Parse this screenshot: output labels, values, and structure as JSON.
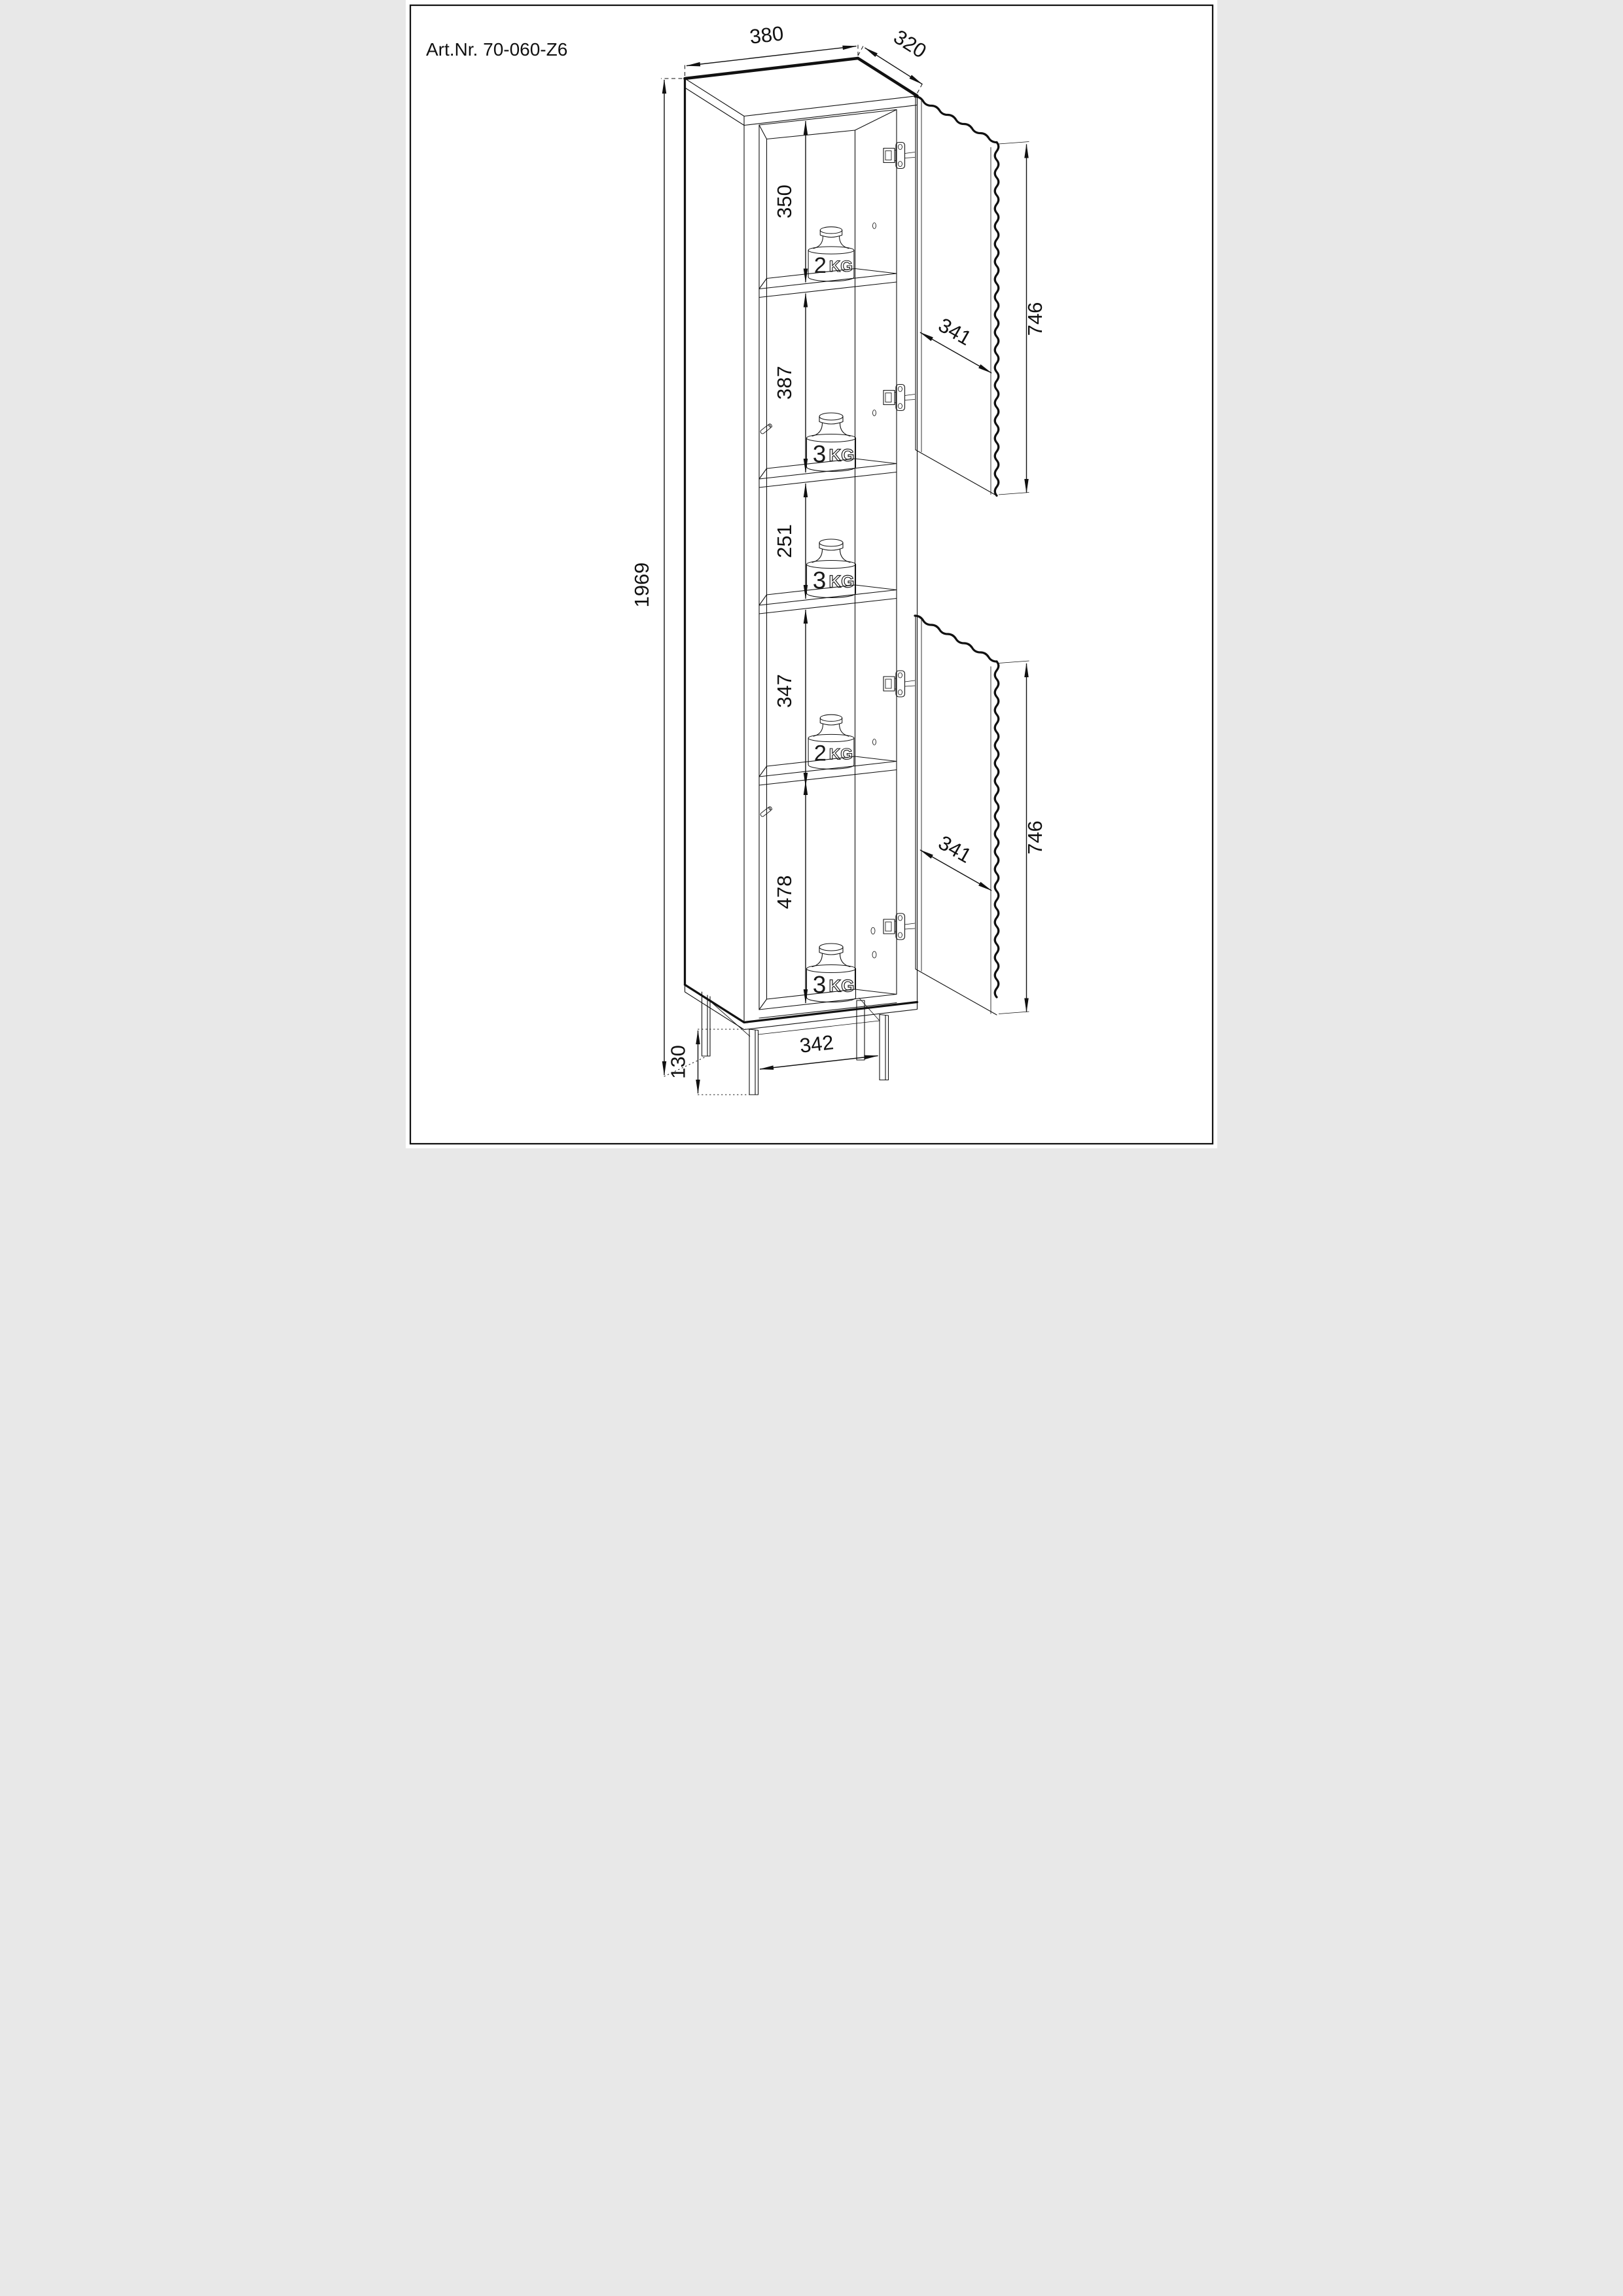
{
  "title": "Art.Nr. 70-060-Z6",
  "dimensions": {
    "width": "380",
    "depth": "320",
    "height": "1969",
    "shelf_gaps": [
      "350",
      "387",
      "251",
      "347",
      "478"
    ],
    "upper_door": {
      "width": "341",
      "height": "746"
    },
    "lower_door": {
      "width": "341",
      "height": "746"
    },
    "base_width": "342",
    "leg_height": "130"
  },
  "weights": [
    {
      "num": "2",
      "unit": "KG"
    },
    {
      "num": "3",
      "unit": "KG"
    },
    {
      "num": "3",
      "unit": "KG"
    },
    {
      "num": "2",
      "unit": "KG"
    },
    {
      "num": "3",
      "unit": "KG"
    }
  ]
}
